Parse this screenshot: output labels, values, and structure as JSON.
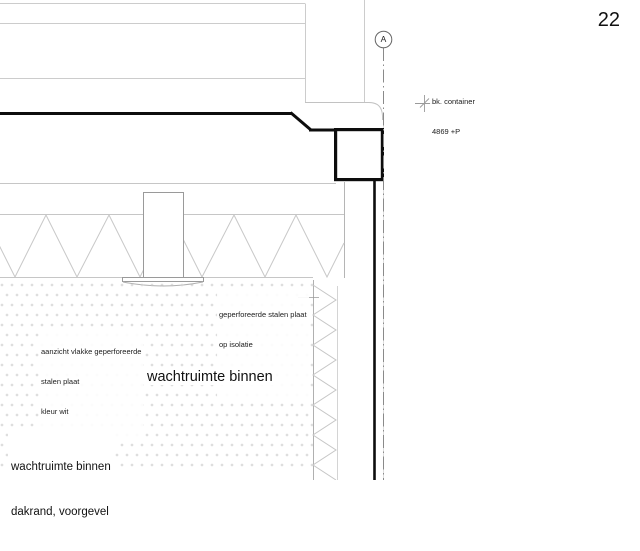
{
  "sheet": {
    "number": "22"
  },
  "section_marker": {
    "label": "A"
  },
  "annotations": {
    "level_note": {
      "line1": "bk. container",
      "line2": "4869 +P"
    },
    "plate_note": {
      "line1": "geperforeerde stalen plaat",
      "line2": "op isolatie",
      "line3": "kleur wit"
    },
    "view_note": {
      "line1": "aanzicht vlakke geperforeerde",
      "line2": "stalen plaat",
      "line3": "kleur wit"
    },
    "room_label": "wachtruimte binnen",
    "title": {
      "line1": "wachtruimte binnen",
      "line2": "dakrand, voorgevel"
    }
  },
  "colors": {
    "heavy_line": "#0d0d0d",
    "light_line": "#c6c6c6",
    "medium_line": "#9a9a9a",
    "centerline": "#8a8a8a",
    "stipple_dot": "#c8c8c8",
    "background": "#ffffff"
  }
}
